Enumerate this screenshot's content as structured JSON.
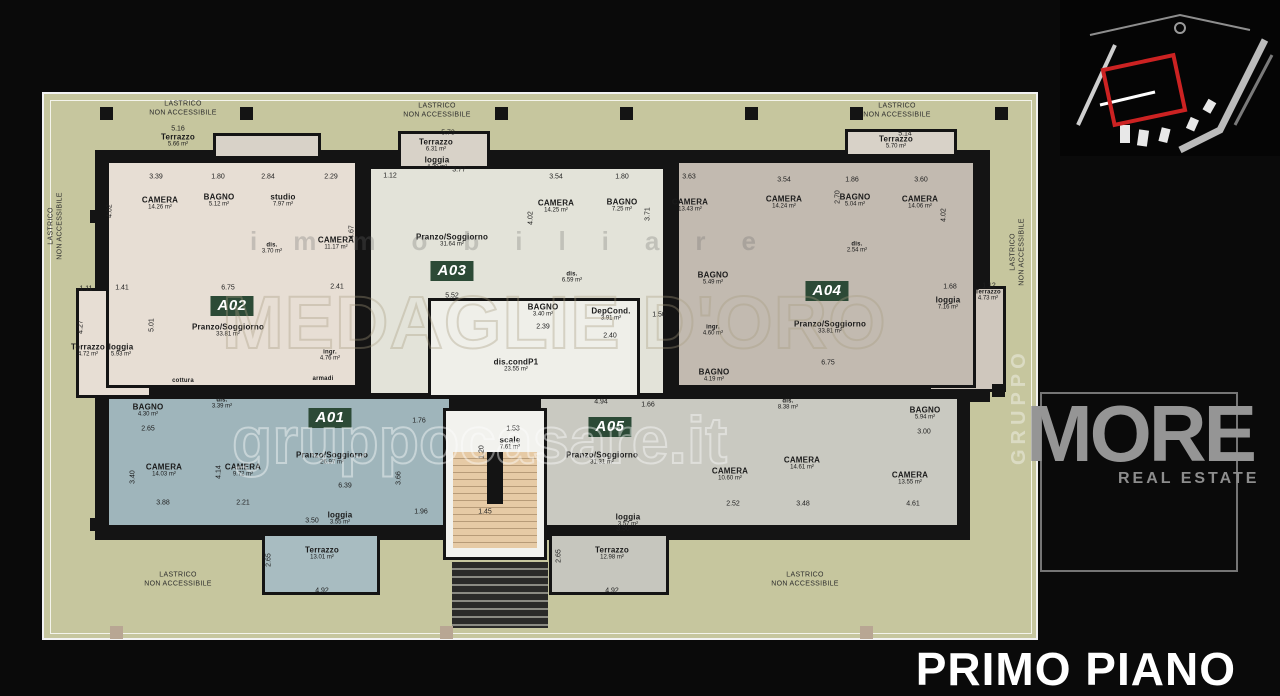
{
  "title": "PRIMO PIANO",
  "palette": {
    "olive": "#c6c69e",
    "cream": "#e7ded4",
    "pale": "#e3e3d9",
    "taupe": "#c2bab0",
    "teal": "#9fb5bb",
    "gray": "#c9c9c1",
    "terrace": "#d8d2c8",
    "badge": "#2c4a36",
    "accent_red": "#cc2222"
  },
  "watermarks": {
    "immobiliare": "immobiliare",
    "medaglie": "MEDAGLIE D'ORO",
    "gruppo_it": "gruppocasare.it",
    "more": "MORE",
    "real_estate": "REAL ESTATE",
    "gruppo_vert": "GRUPPO"
  },
  "badges": [
    {
      "id": "A01",
      "x": 330,
      "y": 418
    },
    {
      "id": "A02",
      "x": 232,
      "y": 306
    },
    {
      "id": "A03",
      "x": 452,
      "y": 271
    },
    {
      "id": "A04",
      "x": 827,
      "y": 291
    },
    {
      "id": "A05",
      "x": 610,
      "y": 427
    }
  ],
  "rooms": [
    {
      "name": "Terrazzo",
      "area": "5.66 m²",
      "x": 178,
      "y": 141
    },
    {
      "name": "CAMERA",
      "area": "14.26 m²",
      "x": 160,
      "y": 204
    },
    {
      "name": "BAGNO",
      "area": "5.12 m²",
      "x": 219,
      "y": 201
    },
    {
      "name": "studio",
      "area": "7.97 m²",
      "x": 283,
      "y": 201
    },
    {
      "name": "dis.",
      "area": "3.70 m²",
      "x": 272,
      "y": 249,
      "tiny": true
    },
    {
      "name": "CAMERA",
      "area": "11.17 m²",
      "x": 336,
      "y": 244
    },
    {
      "name": "Terrazzo",
      "area": "4.72 m²",
      "x": 88,
      "y": 351
    },
    {
      "name": "loggia",
      "area": "5.93 m²",
      "x": 121,
      "y": 351
    },
    {
      "name": "Pranzo/Soggiorno",
      "area": "33.81 m²",
      "x": 228,
      "y": 331
    },
    {
      "name": "ingr.",
      "area": "4.76 m²",
      "x": 330,
      "y": 356,
      "tiny": true
    },
    {
      "name": "cottura",
      "x": 183,
      "y": 381,
      "tiny": true
    },
    {
      "name": "armadi",
      "x": 323,
      "y": 379,
      "tiny": true
    },
    {
      "name": "Terrazzo",
      "area": "6.31 m²",
      "x": 436,
      "y": 146
    },
    {
      "name": "loggia",
      "area": "4.30 m²",
      "x": 437,
      "y": 164
    },
    {
      "name": "Pranzo/Soggiorno",
      "area": "31.64 m²",
      "x": 452,
      "y": 241
    },
    {
      "name": "CAMERA",
      "area": "14.25 m²",
      "x": 556,
      "y": 207
    },
    {
      "name": "BAGNO",
      "area": "7.25 m²",
      "x": 622,
      "y": 206
    },
    {
      "name": "CAMERA",
      "area": "13.43 m²",
      "x": 690,
      "y": 206
    },
    {
      "name": "dis.",
      "area": "6.59 m²",
      "x": 572,
      "y": 278,
      "tiny": true
    },
    {
      "name": "BAGNO",
      "area": "3.40 m²",
      "x": 543,
      "y": 311
    },
    {
      "name": "DepCond.",
      "area": "3.91 m²",
      "x": 611,
      "y": 315
    },
    {
      "name": "dis.condP1",
      "area": "23.55 m²",
      "x": 516,
      "y": 366
    },
    {
      "name": "scale",
      "area": "7.61 m²",
      "x": 510,
      "y": 444
    },
    {
      "name": "Terrazzo",
      "area": "5.70 m²",
      "x": 896,
      "y": 143
    },
    {
      "name": "CAMERA",
      "area": "14.24 m²",
      "x": 784,
      "y": 203
    },
    {
      "name": "BAGNO",
      "area": "5.04 m²",
      "x": 855,
      "y": 201
    },
    {
      "name": "CAMERA",
      "area": "14.06 m²",
      "x": 920,
      "y": 203
    },
    {
      "name": "dis.",
      "area": "2.54 m²",
      "x": 857,
      "y": 248,
      "tiny": true
    },
    {
      "name": "BAGNO",
      "area": "5.49 m²",
      "x": 713,
      "y": 279
    },
    {
      "name": "ingr.",
      "area": "4.60 m²",
      "x": 713,
      "y": 331,
      "tiny": true
    },
    {
      "name": "BAGNO",
      "area": "4.19 m²",
      "x": 714,
      "y": 376
    },
    {
      "name": "Pranzo/Soggiorno",
      "area": "33.81 m²",
      "x": 830,
      "y": 328
    },
    {
      "name": "loggia",
      "area": "7.16 m²",
      "x": 948,
      "y": 304
    },
    {
      "name": "Terrazzo",
      "area": "4.73 m²",
      "x": 988,
      "y": 296,
      "tiny": true
    },
    {
      "name": "BAGNO",
      "area": "4.30 m²",
      "x": 148,
      "y": 411
    },
    {
      "name": "dis.",
      "area": "3.39 m²",
      "x": 222,
      "y": 404,
      "tiny": true
    },
    {
      "name": "CAMERA",
      "area": "14.03 m²",
      "x": 164,
      "y": 471
    },
    {
      "name": "CAMERA",
      "area": "9.72 m²",
      "x": 243,
      "y": 471
    },
    {
      "name": "Pranzo/Soggiorno",
      "area": "26.97 m²",
      "x": 332,
      "y": 459
    },
    {
      "name": "loggia",
      "area": "3.55 m²",
      "x": 340,
      "y": 519
    },
    {
      "name": "Terrazzo",
      "area": "13.01 m²",
      "x": 322,
      "y": 554
    },
    {
      "name": "Pranzo/Soggiorno",
      "area": "31.31 m²",
      "x": 602,
      "y": 459
    },
    {
      "name": "dis.",
      "area": "8.38 m²",
      "x": 788,
      "y": 405,
      "tiny": true
    },
    {
      "name": "CAMERA",
      "area": "10.60 m²",
      "x": 730,
      "y": 475
    },
    {
      "name": "CAMERA",
      "area": "14.61 m²",
      "x": 802,
      "y": 464
    },
    {
      "name": "BAGNO",
      "area": "5.94 m²",
      "x": 925,
      "y": 414
    },
    {
      "name": "CAMERA",
      "area": "13.55 m²",
      "x": 910,
      "y": 479
    },
    {
      "name": "loggia",
      "area": "3.57 m²",
      "x": 628,
      "y": 521
    },
    {
      "name": "Terrazzo",
      "area": "12.98 m²",
      "x": 612,
      "y": 554
    }
  ],
  "lastrico_labels": [
    {
      "text": "LASTRICO\nNON ACCESSIBILE",
      "x": 183,
      "y": 109
    },
    {
      "text": "LASTRICO\nNON ACCESSIBILE",
      "x": 437,
      "y": 111
    },
    {
      "text": "LASTRICO\nNON ACCESSIBILE",
      "x": 897,
      "y": 111
    },
    {
      "text": "LASTRICO\nNON ACCESSIBILE",
      "x": 56,
      "y": 226,
      "rot": true
    },
    {
      "text": "LASTRICO\nNON ACCESSIBILE",
      "x": 1018,
      "y": 252,
      "rot": true
    },
    {
      "text": "LASTRICO\nNON ACCESSIBILE",
      "x": 178,
      "y": 580
    },
    {
      "text": "LASTRICO\nNON ACCESSIBILE",
      "x": 805,
      "y": 580
    }
  ],
  "dims": [
    {
      "t": "5.16",
      "x": 178,
      "y": 129
    },
    {
      "t": "3.39",
      "x": 156,
      "y": 177
    },
    {
      "t": "1.80",
      "x": 218,
      "y": 177
    },
    {
      "t": "2.84",
      "x": 268,
      "y": 177
    },
    {
      "t": "2.29",
      "x": 331,
      "y": 177
    },
    {
      "t": "1.12",
      "x": 390,
      "y": 176
    },
    {
      "t": "4.02",
      "x": 110,
      "y": 211,
      "r": true
    },
    {
      "t": "4.67",
      "x": 352,
      "y": 232,
      "r": true
    },
    {
      "t": "5.73",
      "x": 448,
      "y": 133
    },
    {
      "t": "3.77",
      "x": 459,
      "y": 170
    },
    {
      "t": "3.54",
      "x": 556,
      "y": 177
    },
    {
      "t": "1.80",
      "x": 622,
      "y": 177
    },
    {
      "t": "3.63",
      "x": 689,
      "y": 177
    },
    {
      "t": "4.02",
      "x": 531,
      "y": 218,
      "r": true
    },
    {
      "t": "3.71",
      "x": 648,
      "y": 214,
      "r": true
    },
    {
      "t": "5.14",
      "x": 905,
      "y": 134
    },
    {
      "t": "3.54",
      "x": 784,
      "y": 180
    },
    {
      "t": "1.86",
      "x": 852,
      "y": 180
    },
    {
      "t": "3.60",
      "x": 921,
      "y": 180
    },
    {
      "t": "2.70",
      "x": 838,
      "y": 197,
      "r": true
    },
    {
      "t": "4.02",
      "x": 944,
      "y": 215,
      "r": true
    },
    {
      "t": "1.11",
      "x": 86,
      "y": 289
    },
    {
      "t": "1.41",
      "x": 122,
      "y": 288
    },
    {
      "t": "6.75",
      "x": 228,
      "y": 288
    },
    {
      "t": "2.41",
      "x": 337,
      "y": 287
    },
    {
      "t": "5.01",
      "x": 152,
      "y": 325,
      "r": true
    },
    {
      "t": "4.27",
      "x": 81,
      "y": 327,
      "r": true
    },
    {
      "t": "5.52",
      "x": 452,
      "y": 296
    },
    {
      "t": "2.39",
      "x": 543,
      "y": 327
    },
    {
      "t": "2.40",
      "x": 610,
      "y": 336
    },
    {
      "t": "1.50",
      "x": 659,
      "y": 315
    },
    {
      "t": "6.75",
      "x": 828,
      "y": 363
    },
    {
      "t": "1.68",
      "x": 950,
      "y": 287
    },
    {
      "t": "1.12",
      "x": 989,
      "y": 286
    },
    {
      "t": "2.65",
      "x": 148,
      "y": 429
    },
    {
      "t": "3.88",
      "x": 163,
      "y": 503
    },
    {
      "t": "2.21",
      "x": 243,
      "y": 503
    },
    {
      "t": "4.14",
      "x": 219,
      "y": 472,
      "r": true
    },
    {
      "t": "3.40",
      "x": 133,
      "y": 477,
      "r": true
    },
    {
      "t": "6.39",
      "x": 345,
      "y": 486
    },
    {
      "t": "3.66",
      "x": 399,
      "y": 478,
      "r": true
    },
    {
      "t": "1.76",
      "x": 419,
      "y": 421
    },
    {
      "t": "3.50",
      "x": 312,
      "y": 521
    },
    {
      "t": "1.96",
      "x": 421,
      "y": 512
    },
    {
      "t": "4.92",
      "x": 322,
      "y": 591
    },
    {
      "t": "1.53",
      "x": 513,
      "y": 429
    },
    {
      "t": "1.20",
      "x": 482,
      "y": 452,
      "r": true
    },
    {
      "t": "4.94",
      "x": 601,
      "y": 402
    },
    {
      "t": "1.66",
      "x": 648,
      "y": 405
    },
    {
      "t": "2.52",
      "x": 733,
      "y": 504
    },
    {
      "t": "3.48",
      "x": 803,
      "y": 504
    },
    {
      "t": "4.61",
      "x": 913,
      "y": 504
    },
    {
      "t": "1.45",
      "x": 485,
      "y": 512
    },
    {
      "t": "3.50",
      "x": 623,
      "y": 529
    },
    {
      "t": "4.92",
      "x": 612,
      "y": 591
    },
    {
      "t": "3.00",
      "x": 924,
      "y": 432
    },
    {
      "t": "2.65",
      "x": 559,
      "y": 556,
      "r": true
    },
    {
      "t": "2.65",
      "x": 269,
      "y": 560,
      "r": true
    }
  ]
}
